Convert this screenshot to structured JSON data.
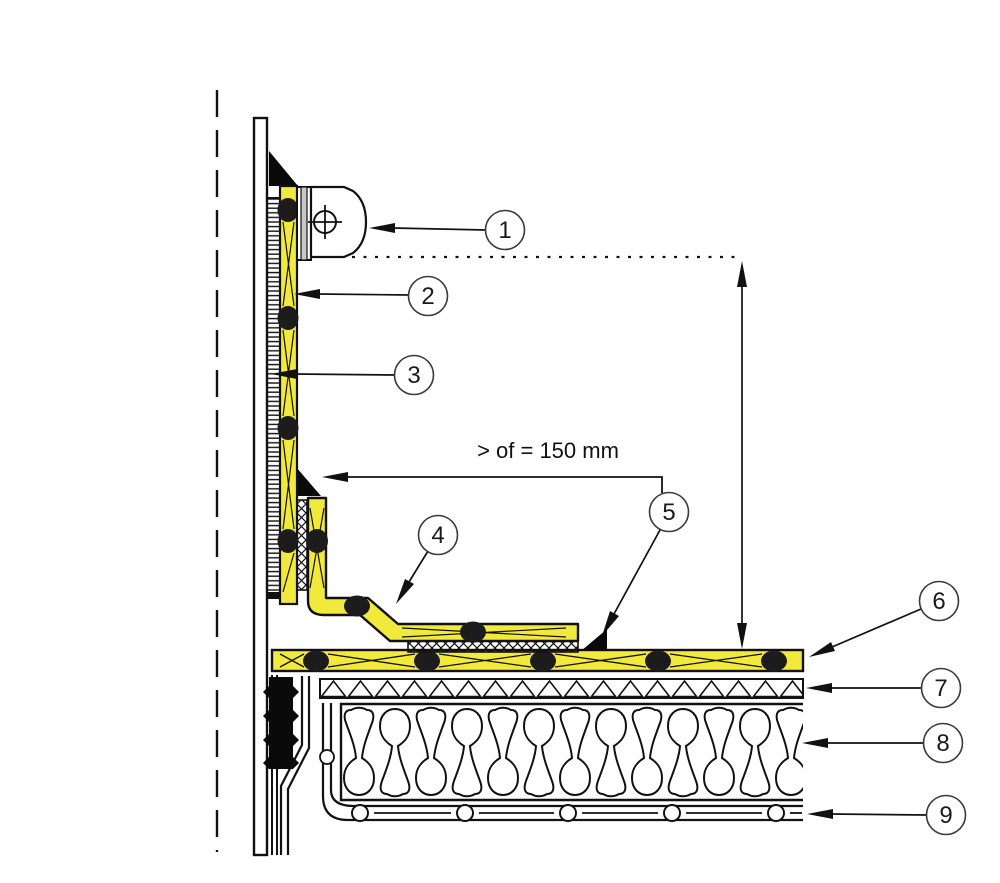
{
  "diagram": {
    "dimension_label": "> of = 150 mm",
    "callouts": [
      {
        "label": "1"
      },
      {
        "label": "2"
      },
      {
        "label": "3"
      },
      {
        "label": "4"
      },
      {
        "label": "5"
      },
      {
        "label": "6"
      },
      {
        "label": "7"
      },
      {
        "label": "8"
      },
      {
        "label": "9"
      }
    ],
    "colors": {
      "membrane_yellow": "#F1E93B",
      "line": "#111111",
      "callout_stroke": "#3a3a3a",
      "background": "#FFFFFF"
    }
  }
}
